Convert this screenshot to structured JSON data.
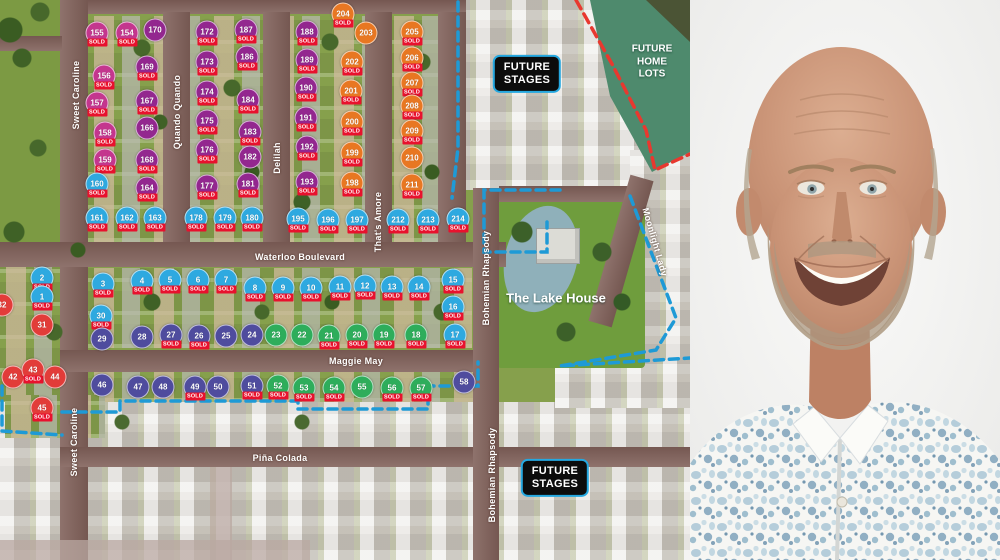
{
  "map": {
    "sold_label": "SOLD",
    "colors": {
      "purple": "#93278f",
      "pink": "#c4368e",
      "orange": "#e87722",
      "blue": "#2ea9e0",
      "indigo": "#4f4c9e",
      "green": "#2ead5b",
      "red": "#e23c39",
      "sold_bg": "#e8112d",
      "boundary_blue": "#1e9ad6",
      "boundary_red": "#e8382f",
      "badge_border": "#25a8e0",
      "badge_bg": "#0c0c0c"
    },
    "labels": {
      "lake_house": "The Lake House",
      "future_home_lots": {
        "l1": "FUTURE",
        "l2": "HOME",
        "l3": "LOTS"
      }
    },
    "badges": [
      {
        "l1": "FUTURE",
        "l2": "STAGES",
        "x": 527,
        "y": 74
      },
      {
        "l1": "FUTURE",
        "l2": "STAGES",
        "x": 555,
        "y": 478
      }
    ],
    "streets": [
      {
        "label": "Sweet Caroline",
        "x": 76,
        "y": 95,
        "rot": -90
      },
      {
        "label": "Quando Quando",
        "x": 177,
        "y": 112,
        "rot": -90
      },
      {
        "label": "Delilah",
        "x": 277,
        "y": 158,
        "rot": -90
      },
      {
        "label": "That's Amore",
        "x": 378,
        "y": 222,
        "rot": -90
      },
      {
        "label": "Waterloo Boulevard",
        "x": 300,
        "y": 257
      },
      {
        "label": "Maggie May",
        "x": 356,
        "y": 361
      },
      {
        "label": "Piña Colada",
        "x": 280,
        "y": 458
      },
      {
        "label": "Bohemian Rhapsody",
        "x": 486,
        "y": 278,
        "rot": -90
      },
      {
        "label": "Bohemian Rhapsody",
        "x": 492,
        "y": 475,
        "rot": -90
      },
      {
        "label": "Sweet Caroline",
        "x": 74,
        "y": 442,
        "rot": -90
      },
      {
        "label": "Moonlight Lady",
        "x": 655,
        "y": 242,
        "rot": 74
      }
    ],
    "lots": [
      {
        "n": "155",
        "c": "pink",
        "s": true,
        "x": 97,
        "y": 33
      },
      {
        "n": "154",
        "c": "pink",
        "s": true,
        "x": 127,
        "y": 33
      },
      {
        "n": "170",
        "c": "purple",
        "s": false,
        "x": 155,
        "y": 30
      },
      {
        "n": "172",
        "c": "purple",
        "s": true,
        "x": 207,
        "y": 32
      },
      {
        "n": "187",
        "c": "purple",
        "s": true,
        "x": 246,
        "y": 30
      },
      {
        "n": "188",
        "c": "purple",
        "s": true,
        "x": 307,
        "y": 32
      },
      {
        "n": "204",
        "c": "orange",
        "s": true,
        "x": 343,
        "y": 14
      },
      {
        "n": "203",
        "c": "orange",
        "s": false,
        "x": 366,
        "y": 33
      },
      {
        "n": "205",
        "c": "orange",
        "s": true,
        "x": 412,
        "y": 32
      },
      {
        "n": "156",
        "c": "pink",
        "s": true,
        "x": 104,
        "y": 76
      },
      {
        "n": "169",
        "c": "purple",
        "s": true,
        "x": 147,
        "y": 67
      },
      {
        "n": "173",
        "c": "purple",
        "s": true,
        "x": 207,
        "y": 62
      },
      {
        "n": "186",
        "c": "purple",
        "s": true,
        "x": 247,
        "y": 57
      },
      {
        "n": "189",
        "c": "purple",
        "s": true,
        "x": 307,
        "y": 60
      },
      {
        "n": "202",
        "c": "orange",
        "s": true,
        "x": 352,
        "y": 62
      },
      {
        "n": "206",
        "c": "orange",
        "s": true,
        "x": 412,
        "y": 58
      },
      {
        "n": "157",
        "c": "pink",
        "s": true,
        "x": 97,
        "y": 103
      },
      {
        "n": "167",
        "c": "purple",
        "s": true,
        "x": 147,
        "y": 101
      },
      {
        "n": "174",
        "c": "purple",
        "s": true,
        "x": 207,
        "y": 92
      },
      {
        "n": "184",
        "c": "purple",
        "s": true,
        "x": 248,
        "y": 100
      },
      {
        "n": "190",
        "c": "purple",
        "s": true,
        "x": 306,
        "y": 88
      },
      {
        "n": "201",
        "c": "orange",
        "s": true,
        "x": 351,
        "y": 91
      },
      {
        "n": "207",
        "c": "orange",
        "s": true,
        "x": 412,
        "y": 83
      },
      {
        "n": "158",
        "c": "pink",
        "s": true,
        "x": 105,
        "y": 133
      },
      {
        "n": "166",
        "c": "purple",
        "s": false,
        "x": 147,
        "y": 128
      },
      {
        "n": "175",
        "c": "purple",
        "s": true,
        "x": 207,
        "y": 121
      },
      {
        "n": "183",
        "c": "purple",
        "s": true,
        "x": 250,
        "y": 132
      },
      {
        "n": "191",
        "c": "purple",
        "s": true,
        "x": 306,
        "y": 118
      },
      {
        "n": "200",
        "c": "orange",
        "s": true,
        "x": 352,
        "y": 122
      },
      {
        "n": "208",
        "c": "orange",
        "s": true,
        "x": 412,
        "y": 106
      },
      {
        "n": "159",
        "c": "pink",
        "s": true,
        "x": 105,
        "y": 160
      },
      {
        "n": "168",
        "c": "purple",
        "s": true,
        "x": 147,
        "y": 160
      },
      {
        "n": "176",
        "c": "purple",
        "s": true,
        "x": 207,
        "y": 150
      },
      {
        "n": "182",
        "c": "purple",
        "s": false,
        "x": 250,
        "y": 157
      },
      {
        "n": "192",
        "c": "purple",
        "s": true,
        "x": 307,
        "y": 147
      },
      {
        "n": "199",
        "c": "orange",
        "s": true,
        "x": 352,
        "y": 153
      },
      {
        "n": "209",
        "c": "orange",
        "s": true,
        "x": 412,
        "y": 131
      },
      {
        "n": "160",
        "c": "blue",
        "s": true,
        "x": 97,
        "y": 184
      },
      {
        "n": "164",
        "c": "purple",
        "s": true,
        "x": 147,
        "y": 188
      },
      {
        "n": "177",
        "c": "purple",
        "s": true,
        "x": 207,
        "y": 186
      },
      {
        "n": "181",
        "c": "purple",
        "s": true,
        "x": 248,
        "y": 184
      },
      {
        "n": "193",
        "c": "purple",
        "s": true,
        "x": 307,
        "y": 182
      },
      {
        "n": "198",
        "c": "orange",
        "s": true,
        "x": 352,
        "y": 183
      },
      {
        "n": "210",
        "c": "orange",
        "s": false,
        "x": 412,
        "y": 158
      },
      {
        "n": "211",
        "c": "orange",
        "s": true,
        "x": 412,
        "y": 185
      },
      {
        "n": "161",
        "c": "blue",
        "s": true,
        "x": 97,
        "y": 218
      },
      {
        "n": "162",
        "c": "blue",
        "s": true,
        "x": 127,
        "y": 218
      },
      {
        "n": "163",
        "c": "blue",
        "s": true,
        "x": 155,
        "y": 218
      },
      {
        "n": "178",
        "c": "blue",
        "s": true,
        "x": 196,
        "y": 218
      },
      {
        "n": "179",
        "c": "blue",
        "s": true,
        "x": 225,
        "y": 218
      },
      {
        "n": "180",
        "c": "blue",
        "s": true,
        "x": 252,
        "y": 218
      },
      {
        "n": "195",
        "c": "blue",
        "s": true,
        "x": 298,
        "y": 219
      },
      {
        "n": "196",
        "c": "blue",
        "s": true,
        "x": 328,
        "y": 220
      },
      {
        "n": "197",
        "c": "blue",
        "s": true,
        "x": 357,
        "y": 220
      },
      {
        "n": "212",
        "c": "blue",
        "s": true,
        "x": 398,
        "y": 220
      },
      {
        "n": "213",
        "c": "blue",
        "s": true,
        "x": 428,
        "y": 220
      },
      {
        "n": "214",
        "c": "blue",
        "s": true,
        "x": 458,
        "y": 219
      },
      {
        "n": "2",
        "c": "blue",
        "s": true,
        "x": 42,
        "y": 278
      },
      {
        "n": "1",
        "c": "blue",
        "s": true,
        "x": 42,
        "y": 297
      },
      {
        "n": "31",
        "c": "red",
        "s": false,
        "x": 42,
        "y": 325
      },
      {
        "n": "32",
        "c": "red",
        "s": false,
        "x": 2,
        "y": 305
      },
      {
        "n": "3",
        "c": "blue",
        "s": true,
        "x": 103,
        "y": 284
      },
      {
        "n": "30",
        "c": "blue",
        "s": true,
        "x": 101,
        "y": 316
      },
      {
        "n": "29",
        "c": "indigo",
        "s": false,
        "x": 102,
        "y": 339
      },
      {
        "n": "4",
        "c": "blue",
        "s": true,
        "x": 142,
        "y": 281
      },
      {
        "n": "5",
        "c": "blue",
        "s": true,
        "x": 170,
        "y": 280
      },
      {
        "n": "6",
        "c": "blue",
        "s": true,
        "x": 198,
        "y": 280
      },
      {
        "n": "7",
        "c": "blue",
        "s": true,
        "x": 226,
        "y": 280
      },
      {
        "n": "8",
        "c": "blue",
        "s": true,
        "x": 255,
        "y": 288
      },
      {
        "n": "9",
        "c": "blue",
        "s": true,
        "x": 283,
        "y": 288
      },
      {
        "n": "10",
        "c": "blue",
        "s": true,
        "x": 311,
        "y": 288
      },
      {
        "n": "11",
        "c": "blue",
        "s": true,
        "x": 340,
        "y": 287
      },
      {
        "n": "12",
        "c": "blue",
        "s": true,
        "x": 365,
        "y": 286
      },
      {
        "n": "13",
        "c": "blue",
        "s": true,
        "x": 392,
        "y": 287
      },
      {
        "n": "14",
        "c": "blue",
        "s": true,
        "x": 419,
        "y": 287
      },
      {
        "n": "15",
        "c": "blue",
        "s": true,
        "x": 453,
        "y": 280
      },
      {
        "n": "16",
        "c": "blue",
        "s": true,
        "x": 453,
        "y": 307
      },
      {
        "n": "17",
        "c": "blue",
        "s": true,
        "x": 455,
        "y": 335
      },
      {
        "n": "28",
        "c": "indigo",
        "s": false,
        "x": 142,
        "y": 337
      },
      {
        "n": "27",
        "c": "indigo",
        "s": true,
        "x": 171,
        "y": 335
      },
      {
        "n": "26",
        "c": "indigo",
        "s": true,
        "x": 199,
        "y": 336
      },
      {
        "n": "25",
        "c": "indigo",
        "s": false,
        "x": 226,
        "y": 336
      },
      {
        "n": "24",
        "c": "indigo",
        "s": false,
        "x": 252,
        "y": 335
      },
      {
        "n": "23",
        "c": "green",
        "s": false,
        "x": 276,
        "y": 335
      },
      {
        "n": "22",
        "c": "green",
        "s": false,
        "x": 302,
        "y": 335
      },
      {
        "n": "21",
        "c": "green",
        "s": true,
        "x": 329,
        "y": 336
      },
      {
        "n": "20",
        "c": "green",
        "s": true,
        "x": 357,
        "y": 335
      },
      {
        "n": "19",
        "c": "green",
        "s": true,
        "x": 384,
        "y": 335
      },
      {
        "n": "18",
        "c": "green",
        "s": true,
        "x": 416,
        "y": 335
      },
      {
        "n": "42",
        "c": "red",
        "s": false,
        "x": 13,
        "y": 377
      },
      {
        "n": "43",
        "c": "red",
        "s": true,
        "x": 33,
        "y": 370
      },
      {
        "n": "44",
        "c": "red",
        "s": false,
        "x": 55,
        "y": 377
      },
      {
        "n": "45",
        "c": "red",
        "s": true,
        "x": 42,
        "y": 408
      },
      {
        "n": "46",
        "c": "indigo",
        "s": false,
        "x": 102,
        "y": 385
      },
      {
        "n": "47",
        "c": "indigo",
        "s": false,
        "x": 138,
        "y": 387
      },
      {
        "n": "48",
        "c": "indigo",
        "s": false,
        "x": 163,
        "y": 387
      },
      {
        "n": "49",
        "c": "indigo",
        "s": true,
        "x": 195,
        "y": 387
      },
      {
        "n": "50",
        "c": "indigo",
        "s": false,
        "x": 218,
        "y": 387
      },
      {
        "n": "51",
        "c": "indigo",
        "s": true,
        "x": 252,
        "y": 386
      },
      {
        "n": "52",
        "c": "green",
        "s": true,
        "x": 278,
        "y": 386
      },
      {
        "n": "53",
        "c": "green",
        "s": true,
        "x": 304,
        "y": 388
      },
      {
        "n": "54",
        "c": "green",
        "s": true,
        "x": 334,
        "y": 388
      },
      {
        "n": "55",
        "c": "green",
        "s": false,
        "x": 362,
        "y": 387
      },
      {
        "n": "56",
        "c": "green",
        "s": true,
        "x": 392,
        "y": 388
      },
      {
        "n": "57",
        "c": "green",
        "s": true,
        "x": 421,
        "y": 388
      },
      {
        "n": "58",
        "c": "indigo",
        "s": false,
        "x": 464,
        "y": 382
      }
    ]
  }
}
